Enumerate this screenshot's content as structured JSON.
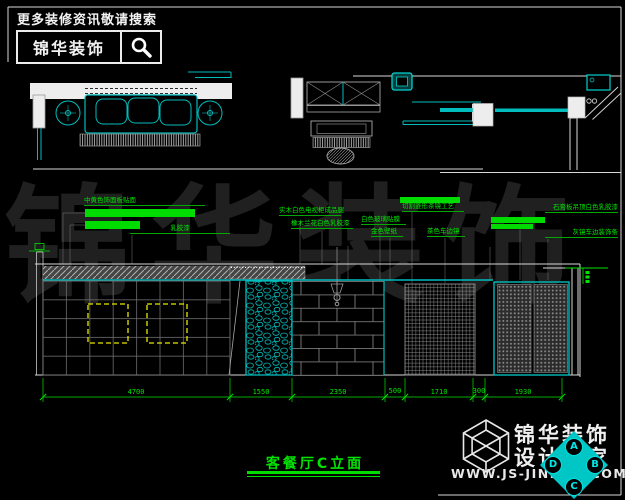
{
  "header": {
    "slogan": "更多装修资讯敬请搜索",
    "brand": "锦华装饰"
  },
  "icons": {
    "search": "magnifier",
    "logo": "cube-wireframe"
  },
  "watermark": "锦华装饰",
  "callouts": [
    "中黄色饰面板贴面",
    "乳胶漆",
    "实木白色电视柜成品腿",
    "橡木兰花白色乳胶漆",
    "切割菱形茶镜工艺",
    "白色玻璃贴膜",
    "金色壁纸",
    "茶色车边镜",
    "石膏板吊顶白色乳胶漆",
    "灰镜车边装饰条"
  ],
  "dimensions": [
    "4700",
    "1550",
    "2350",
    "500",
    "1710",
    "300",
    "1930"
  ],
  "drawing_title": "客餐厅C立面",
  "footer": {
    "brand": "锦华装饰",
    "tagline": "设计专家",
    "website": "WWW.JS-JINHUA.COM"
  },
  "elevation_marker": {
    "top": "A",
    "right": "B",
    "bottom": "C",
    "left": "D"
  },
  "colors": {
    "accent_green": "#00e400",
    "accent_cyan": "#00bcbc",
    "highlight_yellow": "#e8e800",
    "line_white": "#d8d8d8"
  }
}
